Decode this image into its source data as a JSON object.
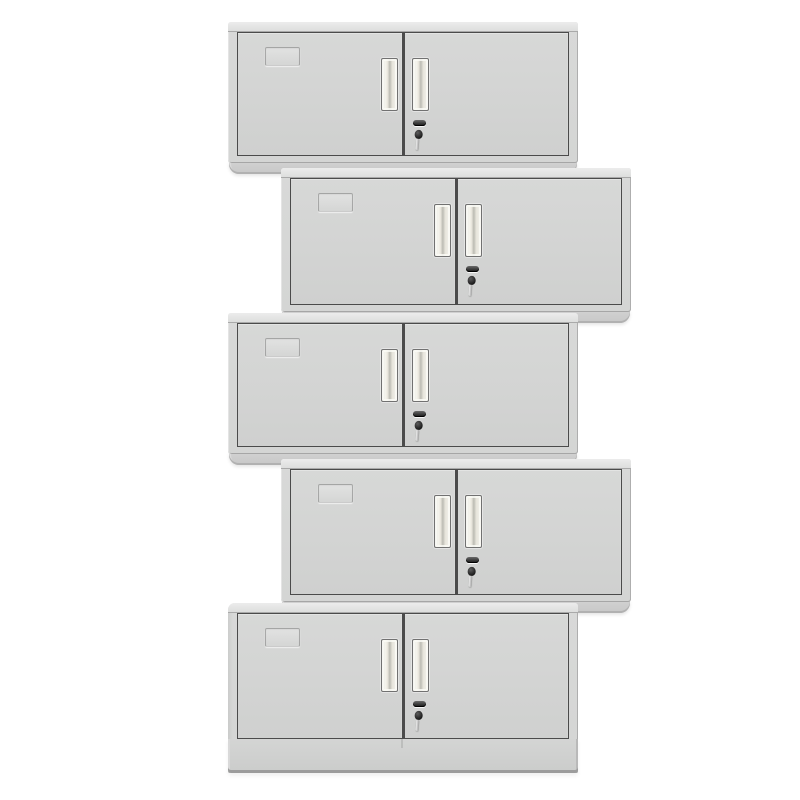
{
  "image": {
    "kind": "product-photo",
    "subject": "Five light-grey two-door steel office cabinets stacked vertically in a zigzag pattern with alternating left and right offsets on a plain white background",
    "background_color": "#ffffff",
    "text_content": "none"
  },
  "stack": {
    "unit_count": 5,
    "arrangement": "vertical stack, offsets alternate left, right, left, right, left (top to bottom)",
    "units": [
      {
        "index": 1,
        "offset": "left",
        "has_base": false
      },
      {
        "index": 2,
        "offset": "right",
        "has_base": false
      },
      {
        "index": 3,
        "offset": "left",
        "has_base": false
      },
      {
        "index": 4,
        "offset": "right",
        "has_base": false
      },
      {
        "index": 5,
        "offset": "left",
        "has_base": true
      }
    ]
  },
  "unit_features": {
    "doors_per_unit": 2,
    "label_card_holder": "embossed card slot on the upper-left of the left door",
    "handles": "two vertical recessed handles flanking the centre door gap",
    "lock": "cam lock on the right door below the handle with a key inserted and hanging down",
    "bottom_unit_extra": "tall plinth base below the doors"
  },
  "colors": {
    "background": "#ffffff",
    "cabinet_frame": "#d8d9d8",
    "door_panel": "#d3d4d3",
    "door_outline": "#4b4b4b",
    "top_edge_highlight": "#ececec",
    "foot_shadow": "#c7c7c7",
    "handle_fill": "#ece9e0",
    "handle_outline": "#717171",
    "lock_dark": "#141414",
    "key_shaft": "#9f9f9f",
    "base_bottom_edge": "#9c9c9c"
  }
}
